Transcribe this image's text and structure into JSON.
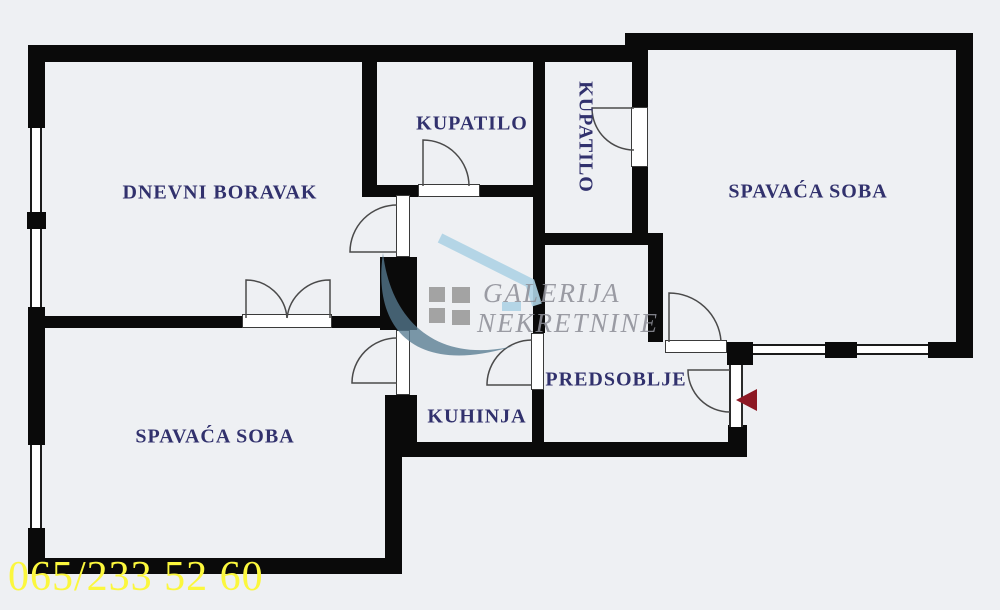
{
  "floorplan": {
    "rooms": [
      {
        "id": "living-room",
        "label": "DNEVNI BORAVAK"
      },
      {
        "id": "bathroom-1",
        "label": "KUPATILO"
      },
      {
        "id": "bathroom-2",
        "label": "KUPATILO"
      },
      {
        "id": "bedroom-right",
        "label": "SPAVAĆA SOBA"
      },
      {
        "id": "bedroom-left",
        "label": "SPAVAĆA SOBA"
      },
      {
        "id": "kitchen",
        "label": "KUHINJA"
      },
      {
        "id": "hallway",
        "label": "PREDSOBLJE"
      }
    ],
    "watermark": {
      "brand_line1": "GALERIJA",
      "brand_line2": "NEKRETNINE"
    },
    "phone_number": "065/233 52 60",
    "colors": {
      "background": "#eef0f3",
      "wall": "#0a0a0a",
      "label_text": "#31316d",
      "phone_text": "#fbf73d",
      "entrance_arrow": "#8d1823",
      "watermark_text": "#8f9099",
      "watermark_accent": "#aed3e5",
      "watermark_swoosh": "#567a90"
    }
  }
}
